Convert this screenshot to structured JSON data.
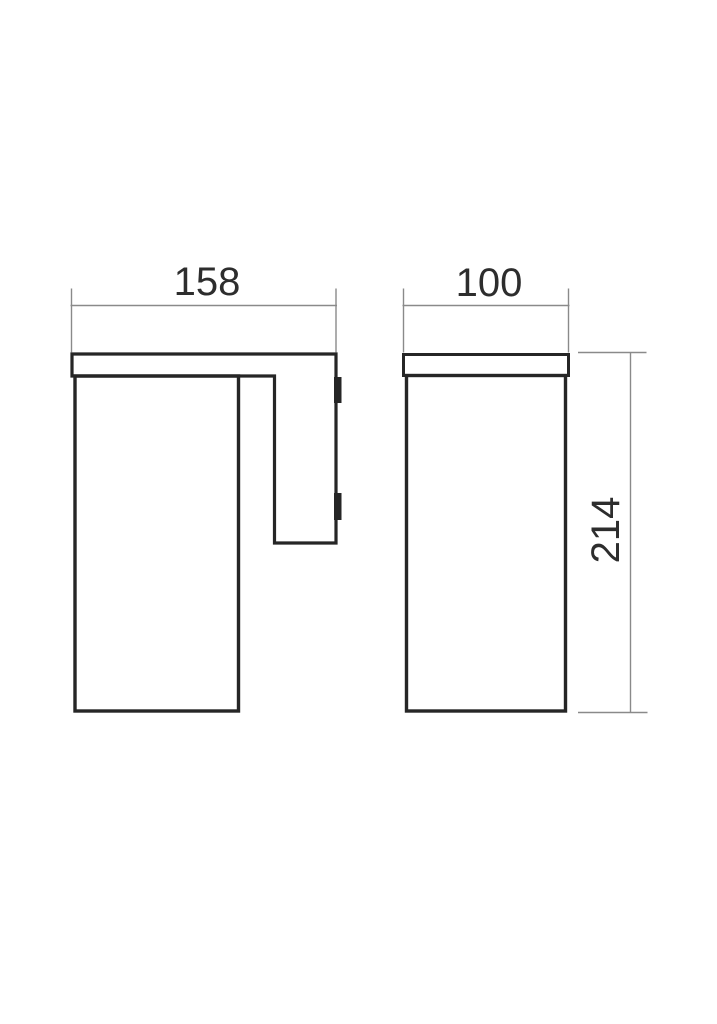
{
  "drawing": {
    "type": "technical-dimension-drawing",
    "colors": {
      "outline": "#262626",
      "dimension_lines": "#8a8a8a",
      "text": "#2d2d2d",
      "background": "#ffffff"
    },
    "views": [
      {
        "id": "side-view"
      },
      {
        "id": "front-view"
      }
    ],
    "dimensions": [
      {
        "id": "side-width",
        "value": "158",
        "orientation": "horizontal"
      },
      {
        "id": "front-width",
        "value": "100",
        "orientation": "horizontal"
      },
      {
        "id": "overall-height",
        "value": "214",
        "orientation": "vertical"
      }
    ]
  }
}
